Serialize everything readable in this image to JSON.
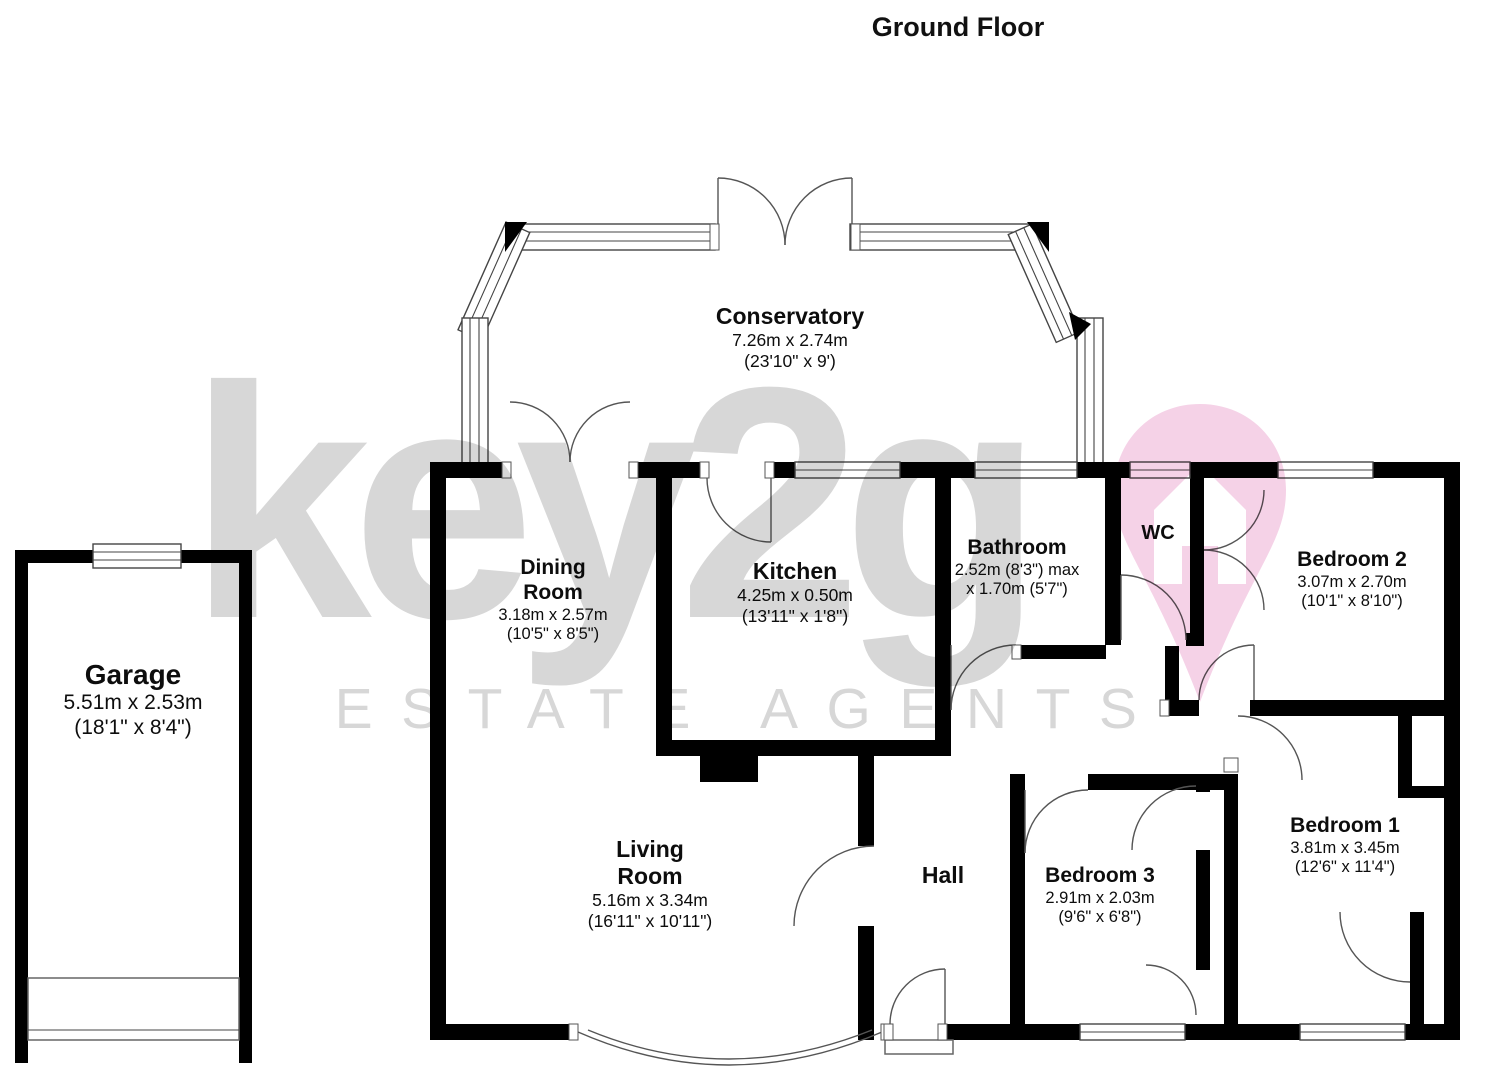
{
  "title": "Ground Floor",
  "watermark": {
    "brand": "key2go",
    "brand_text": "key2g",
    "tagline": "ESTATE AGENTS",
    "text_color": "#d7d7d7",
    "pin_color": "#f5d2e7"
  },
  "colors": {
    "wall": "#000000",
    "line": "#555555",
    "background": "#ffffff"
  },
  "rooms": {
    "garage": {
      "name": "Garage",
      "dims1": "5.51m x 2.53m",
      "dims2": "(18'1\" x 8'4\")"
    },
    "conservatory": {
      "name": "Conservatory",
      "dims1": "7.26m x 2.74m",
      "dims2": "(23'10\" x 9')"
    },
    "dining_room": {
      "name": "Dining Room",
      "dims1": "3.18m x 2.57m",
      "dims2": "(10'5\" x 8'5\")"
    },
    "kitchen": {
      "name": "Kitchen",
      "dims1": "4.25m x 0.50m",
      "dims2": "(13'11\" x 1'8\")"
    },
    "bathroom": {
      "name": "Bathroom",
      "dims1": "2.52m (8'3\") max",
      "dims2": "x 1.70m (5'7\")"
    },
    "wc": {
      "name": "WC"
    },
    "bedroom2": {
      "name": "Bedroom 2",
      "dims1": "3.07m x 2.70m",
      "dims2": "(10'1\" x 8'10\")"
    },
    "living_room": {
      "name": "Living Room",
      "dims1": "5.16m x 3.34m",
      "dims2": "(16'11\" x 10'11\")"
    },
    "hall": {
      "name": "Hall"
    },
    "bedroom3": {
      "name": "Bedroom 3",
      "dims1": "2.91m x 2.03m",
      "dims2": "(9'6\" x 6'8\")"
    },
    "bedroom1": {
      "name": "Bedroom 1",
      "dims1": "3.81m x 3.45m",
      "dims2": "(12'6\" x 11'4\")"
    }
  }
}
